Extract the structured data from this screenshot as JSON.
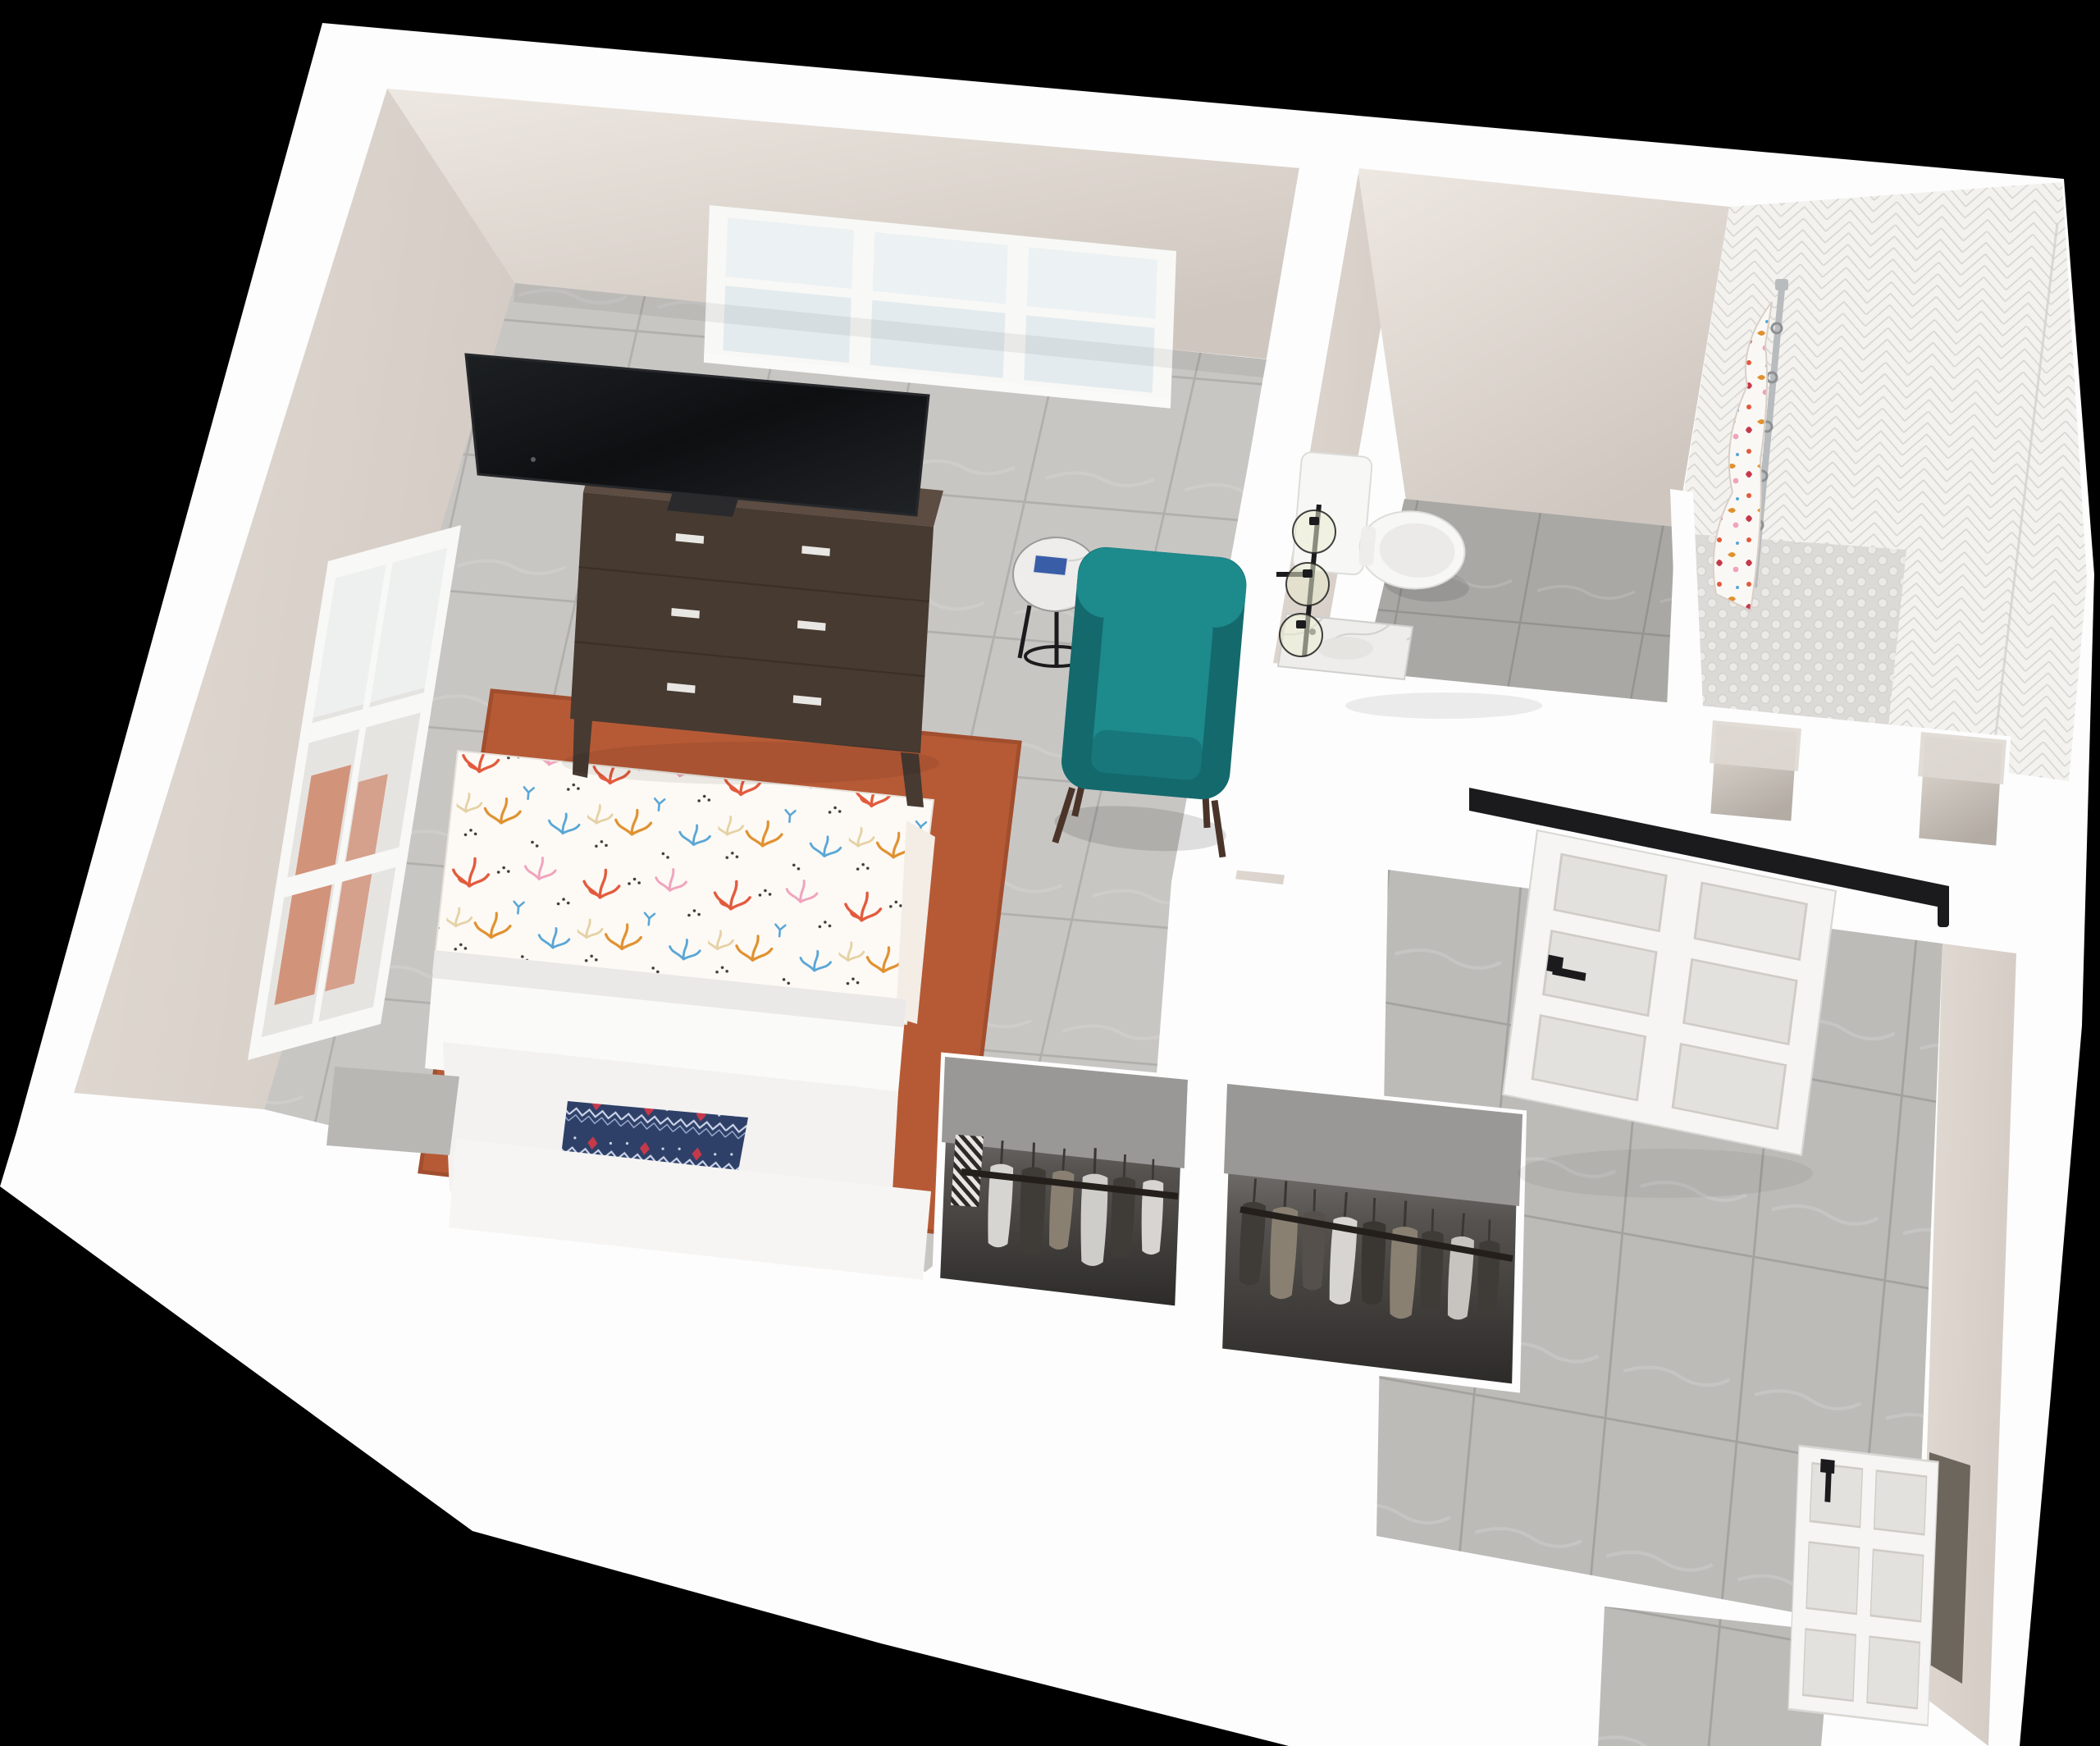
{
  "scene": {
    "type": "3d_floor_plan_rendering",
    "background": "#000000",
    "palette": {
      "wall_top": "#fdfdfd",
      "wall_face": "#e8e1da",
      "wall_face_dark": "#cfc7bf",
      "bedroom_tile": "#c8c6c3",
      "bedroom_grout": "#b0afac",
      "bath_tile": "#a9a8a5",
      "bath_grout": "#949390",
      "hall_tile": "#bcbbb8",
      "hall_grout": "#a3a29f",
      "rug": "#b65a36",
      "rug_edge": "#a14e2e",
      "duvet_base": "#fdfaf6",
      "duvet_coral": "#e25a3c",
      "duvet_pink": "#f0a3bd",
      "duvet_orange": "#e0912f",
      "duvet_blue": "#58a5d5",
      "duvet_tan": "#e5d1a4",
      "duvet_dot": "#3d3a37",
      "blanket_white": "#fafaf9",
      "mattress_white": "#f3f2f0",
      "headboard_white": "#f6f5f3",
      "pillow_navy": "#2f4068",
      "pillow_zig": "#cdd6ea",
      "pillow_red": "#c6394a",
      "pillow_gray": "#b9b7b4",
      "dresser_wood": "#473a31",
      "dresser_wood_top": "#5c4c41",
      "dresser_handle": "#e9e7e3",
      "tv_screen": "#0f1012",
      "tv_stand": "#2a2a2c",
      "chair_teal": "#1d8a8c",
      "chair_teal_dark": "#14696d",
      "chair_leg": "#4a342a",
      "table_marble": "#f1f0ee",
      "metal_black": "#1b1b1d",
      "toilet_white": "#f7f7f5",
      "toilet_shadow": "#dcdcda",
      "vanity_marble": "#efedeb",
      "marble_vein": "#c9c7c4",
      "fixture_glass": "#e9ecce",
      "shower_tile": "#f3f2ee",
      "shower_line": "#d8d6d2",
      "penny": "#eceae6",
      "penny_bg": "#dcdad6",
      "curtain_base": "#faf8f5",
      "chrome": "#b9bcbe",
      "door_white": "#f6f5f3",
      "door_shade": "#e3e1dd",
      "closet_back": "#9a9896",
      "closet_dark": "#2c2a28",
      "garment_light": "#d7d5d1",
      "garment_dark": "#3f3b37",
      "garment_tan": "#8a8072",
      "window_glass": "#e3ebee",
      "window_frame": "#f8f8f6",
      "reflection_salmon": "#cf8a70"
    },
    "objects": [
      "bedroom-floor",
      "bathroom-floor",
      "hallway-floor",
      "entry-threshold",
      "north-window",
      "west-window",
      "dresser",
      "flat-screen-tv",
      "terracotta-rug",
      "bed",
      "coral-duvet",
      "folded-blanket",
      "navy-lumbar-pillow",
      "gray-pillow",
      "headboard",
      "round-side-table",
      "teal-accent-chair",
      "toilet",
      "vanity",
      "sconce-light",
      "walk-in-shower",
      "shower-curtain",
      "shower-rod",
      "storage-niche-1",
      "storage-niche-2",
      "barn-door",
      "barn-door-rail",
      "closet-section-1",
      "closet-section-2",
      "entry-door"
    ]
  }
}
